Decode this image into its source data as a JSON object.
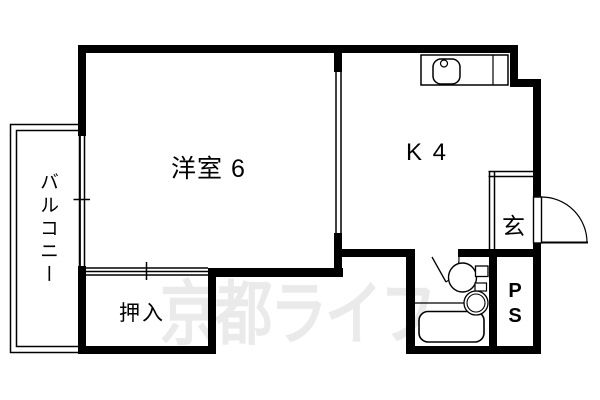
{
  "plan": {
    "title": "apartment-floor-plan-1K",
    "rooms": {
      "western_room": {
        "label": "洋室 6"
      },
      "kitchen": {
        "label": "K 4"
      },
      "entrance": {
        "label": "玄"
      },
      "closet": {
        "label": "押入"
      },
      "balcony": {
        "label": "バルコニー"
      },
      "pipe_space": {
        "label": "PS"
      }
    },
    "fixtures": [
      "kitchen-sink-counter",
      "entry-door-swing",
      "bathroom-door-swing",
      "toilet",
      "washbasin",
      "bathtub",
      "sliding-closet-door",
      "window-left",
      "window-partition"
    ],
    "watermark": {
      "text": "京都ライフ",
      "color": "#eaeaea"
    },
    "colors": {
      "wall": "#000000",
      "background": "#ffffff",
      "label": "#000000"
    }
  }
}
